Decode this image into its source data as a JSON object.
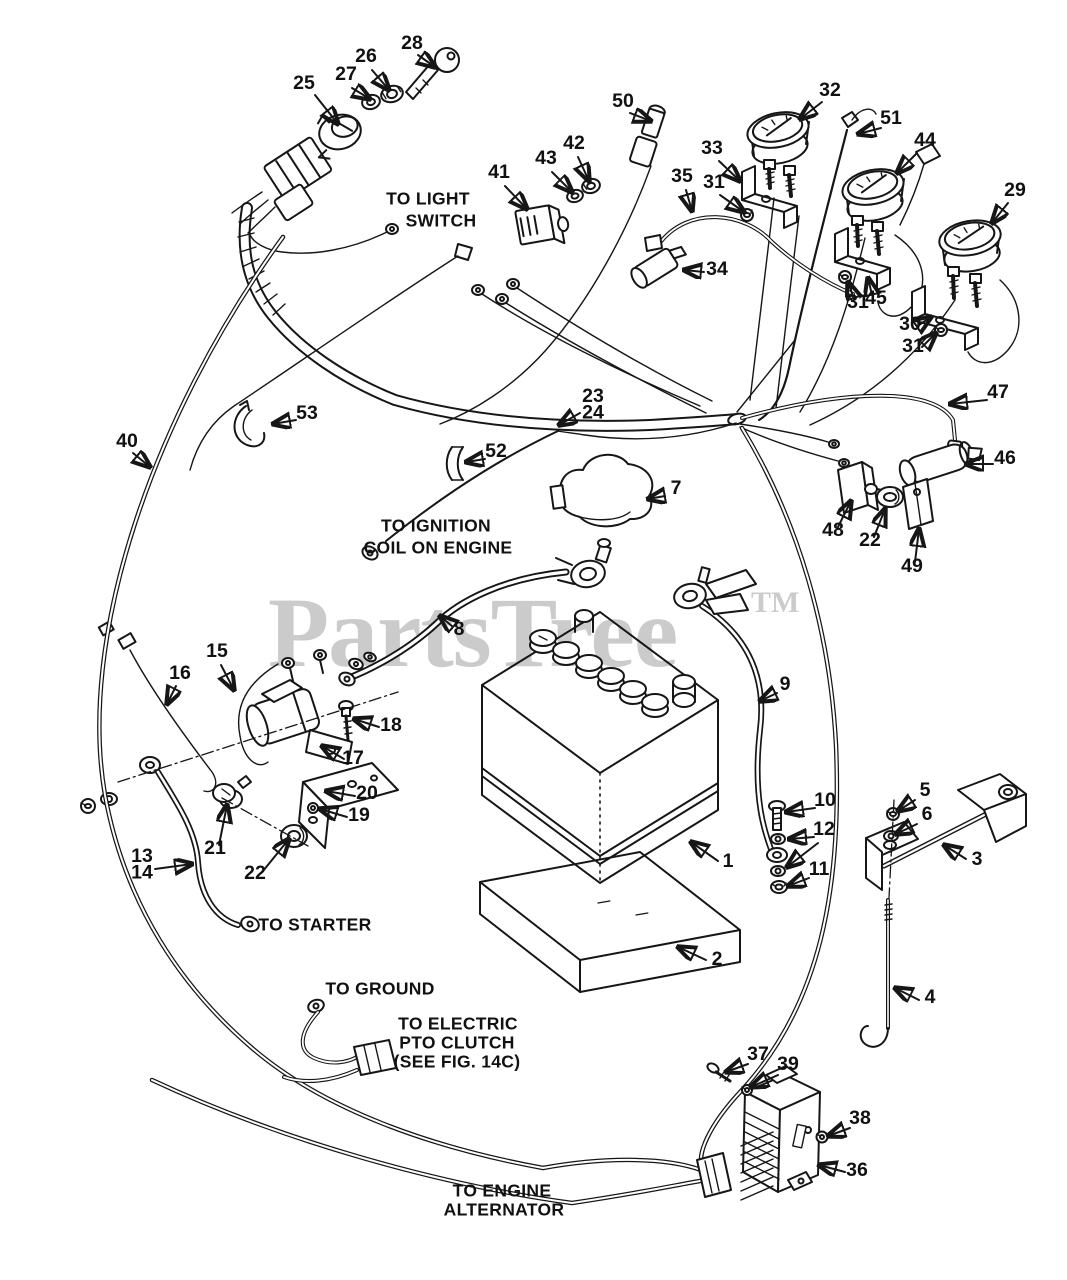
{
  "watermark": {
    "text": "PartsTree",
    "tm": "TM",
    "color": "#cbcbcb"
  },
  "colors": {
    "ink": "#161616",
    "background": "#ffffff"
  },
  "annotations": [
    {
      "id": "to-light-switch",
      "lines": [
        {
          "t": "TO LIGHT",
          "x": 428,
          "y": 200
        },
        {
          "t": "SWITCH",
          "x": 441,
          "y": 222
        }
      ]
    },
    {
      "id": "to-ignition-coil",
      "lines": [
        {
          "t": "TO IGNITION",
          "x": 436,
          "y": 527
        },
        {
          "t": "COIL ON ENGINE",
          "x": 438,
          "y": 549
        }
      ]
    },
    {
      "id": "to-starter",
      "lines": [
        {
          "t": "TO STARTER",
          "x": 315,
          "y": 926
        }
      ]
    },
    {
      "id": "to-ground",
      "lines": [
        {
          "t": "TO GROUND",
          "x": 380,
          "y": 990
        }
      ]
    },
    {
      "id": "to-electric-pto-clutch",
      "lines": [
        {
          "t": "TO ELECTRIC",
          "x": 458,
          "y": 1025
        },
        {
          "t": "PTO CLUTCH",
          "x": 457,
          "y": 1044
        },
        {
          "t": "(SEE FIG. 14C)",
          "x": 457,
          "y": 1063
        }
      ]
    },
    {
      "id": "to-engine-alternator",
      "lines": [
        {
          "t": "TO ENGINE",
          "x": 502,
          "y": 1192
        },
        {
          "t": "ALTERNATOR",
          "x": 504,
          "y": 1211
        }
      ]
    }
  ],
  "callouts": [
    {
      "id": "25",
      "lines": [
        "25"
      ],
      "x": 304,
      "y": 89,
      "arrows": [
        [
          315,
          95,
          338,
          124
        ]
      ]
    },
    {
      "id": "27",
      "lines": [
        "27"
      ],
      "x": 346,
      "y": 80,
      "arrows": [
        [
          352,
          88,
          370,
          99
        ]
      ]
    },
    {
      "id": "26",
      "lines": [
        "26"
      ],
      "x": 366,
      "y": 62,
      "arrows": [
        [
          372,
          70,
          389,
          90
        ]
      ]
    },
    {
      "id": "28",
      "lines": [
        "28"
      ],
      "x": 412,
      "y": 49,
      "arrows": [
        [
          418,
          55,
          435,
          67
        ]
      ]
    },
    {
      "id": "41",
      "lines": [
        "41"
      ],
      "x": 499,
      "y": 178,
      "arrows": [
        [
          505,
          186,
          527,
          209
        ]
      ]
    },
    {
      "id": "43",
      "lines": [
        "43"
      ],
      "x": 546,
      "y": 164,
      "arrows": [
        [
          552,
          172,
          572,
          192
        ]
      ]
    },
    {
      "id": "42",
      "lines": [
        "42"
      ],
      "x": 574,
      "y": 149,
      "arrows": [
        [
          578,
          157,
          589,
          181
        ]
      ]
    },
    {
      "id": "50",
      "lines": [
        "50"
      ],
      "x": 623,
      "y": 107,
      "arrows": [
        [
          630,
          113,
          651,
          121
        ]
      ]
    },
    {
      "id": "32",
      "lines": [
        "32"
      ],
      "x": 830,
      "y": 96,
      "arrows": [
        [
          822,
          102,
          800,
          119
        ]
      ]
    },
    {
      "id": "51",
      "lines": [
        "51"
      ],
      "x": 891,
      "y": 124,
      "arrows": [
        [
          881,
          128,
          858,
          134
        ]
      ]
    },
    {
      "id": "33",
      "lines": [
        "33"
      ],
      "x": 712,
      "y": 154,
      "arrows": [
        [
          719,
          161,
          740,
          181
        ]
      ]
    },
    {
      "id": "31a",
      "lines": [
        "31"
      ],
      "x": 714,
      "y": 188,
      "arrows": [
        [
          720,
          195,
          744,
          212
        ]
      ]
    },
    {
      "id": "35",
      "lines": [
        "35"
      ],
      "x": 682,
      "y": 182,
      "arrows": [
        [
          686,
          190,
          692,
          211
        ]
      ]
    },
    {
      "id": "34",
      "lines": [
        "34"
      ],
      "x": 717,
      "y": 275,
      "arrows": [
        [
          704,
          272,
          684,
          270
        ]
      ]
    },
    {
      "id": "44",
      "lines": [
        "44"
      ],
      "x": 925,
      "y": 146,
      "arrows": [
        [
          917,
          153,
          897,
          173
        ]
      ]
    },
    {
      "id": "29",
      "lines": [
        "29"
      ],
      "x": 1015,
      "y": 196,
      "arrows": [
        [
          1008,
          203,
          992,
          223
        ]
      ]
    },
    {
      "id": "45",
      "lines": [
        "45"
      ],
      "x": 876,
      "y": 304,
      "arrows": [
        [
          872,
          295,
          868,
          278
        ]
      ]
    },
    {
      "id": "31b",
      "lines": [
        "31"
      ],
      "x": 858,
      "y": 308,
      "arrows": [
        [
          854,
          299,
          848,
          282
        ]
      ]
    },
    {
      "id": "30",
      "lines": [
        "30"
      ],
      "x": 910,
      "y": 330,
      "arrows": [
        [
          919,
          325,
          931,
          317
        ]
      ]
    },
    {
      "id": "31c",
      "lines": [
        "31"
      ],
      "x": 913,
      "y": 352,
      "arrows": [
        [
          922,
          347,
          936,
          333
        ]
      ]
    },
    {
      "id": "23-24",
      "lines": [
        "23",
        "24"
      ],
      "x": 593,
      "y": 402,
      "arrows": [
        [
          580,
          413,
          559,
          425
        ]
      ]
    },
    {
      "id": "47",
      "lines": [
        "47"
      ],
      "x": 998,
      "y": 398,
      "arrows": [
        [
          987,
          400,
          950,
          404
        ]
      ]
    },
    {
      "id": "53",
      "lines": [
        "53"
      ],
      "x": 307,
      "y": 419,
      "arrows": [
        [
          296,
          420,
          273,
          424
        ]
      ]
    },
    {
      "id": "40",
      "lines": [
        "40"
      ],
      "x": 127,
      "y": 447,
      "arrows": [
        [
          133,
          453,
          150,
          467
        ]
      ]
    },
    {
      "id": "52",
      "lines": [
        "52"
      ],
      "x": 496,
      "y": 457,
      "arrows": [
        [
          485,
          459,
          466,
          462
        ]
      ]
    },
    {
      "id": "7",
      "lines": [
        "7"
      ],
      "x": 676,
      "y": 494,
      "arrows": [
        [
          665,
          496,
          648,
          499
        ]
      ]
    },
    {
      "id": "46",
      "lines": [
        "46"
      ],
      "x": 1005,
      "y": 464,
      "arrows": [
        [
          993,
          464,
          966,
          464
        ]
      ]
    },
    {
      "id": "48",
      "lines": [
        "48"
      ],
      "x": 833,
      "y": 536,
      "arrows": [
        [
          838,
          527,
          851,
          501
        ]
      ]
    },
    {
      "id": "22a",
      "lines": [
        "22"
      ],
      "x": 870,
      "y": 546,
      "arrows": [
        [
          874,
          537,
          885,
          509
        ]
      ]
    },
    {
      "id": "49",
      "lines": [
        "49"
      ],
      "x": 912,
      "y": 572,
      "arrows": [
        [
          915,
          562,
          919,
          529
        ]
      ]
    },
    {
      "id": "8",
      "lines": [
        "8"
      ],
      "x": 459,
      "y": 635,
      "arrows": [
        [
          453,
          627,
          440,
          616
        ]
      ]
    },
    {
      "id": "9",
      "lines": [
        "9"
      ],
      "x": 785,
      "y": 690,
      "arrows": [
        [
          777,
          693,
          760,
          701
        ]
      ]
    },
    {
      "id": "15",
      "lines": [
        "15"
      ],
      "x": 217,
      "y": 657,
      "arrows": [
        [
          221,
          665,
          234,
          690
        ]
      ]
    },
    {
      "id": "16",
      "lines": [
        "16"
      ],
      "x": 180,
      "y": 679,
      "arrows": [
        [
          176,
          686,
          167,
          704
        ]
      ]
    },
    {
      "id": "18",
      "lines": [
        "18"
      ],
      "x": 391,
      "y": 731,
      "arrows": [
        [
          379,
          727,
          354,
          719
        ]
      ]
    },
    {
      "id": "17",
      "lines": [
        "17"
      ],
      "x": 353,
      "y": 764,
      "arrows": [
        [
          344,
          759,
          322,
          746
        ]
      ]
    },
    {
      "id": "20",
      "lines": [
        "20"
      ],
      "x": 367,
      "y": 799,
      "arrows": [
        [
          355,
          796,
          326,
          791
        ]
      ]
    },
    {
      "id": "19",
      "lines": [
        "19"
      ],
      "x": 359,
      "y": 821,
      "arrows": [
        [
          347,
          817,
          320,
          809
        ]
      ]
    },
    {
      "id": "21",
      "lines": [
        "21"
      ],
      "x": 215,
      "y": 854,
      "arrows": [
        [
          219,
          845,
          227,
          805
        ]
      ]
    },
    {
      "id": "22b",
      "lines": [
        "22"
      ],
      "x": 255,
      "y": 879,
      "arrows": [
        [
          263,
          871,
          289,
          839
        ]
      ]
    },
    {
      "id": "13-14",
      "lines": [
        "13",
        "14"
      ],
      "x": 142,
      "y": 862,
      "arrows": [
        [
          155,
          869,
          192,
          864
        ]
      ]
    },
    {
      "id": "10",
      "lines": [
        "10"
      ],
      "x": 825,
      "y": 806,
      "arrows": [
        [
          815,
          808,
          786,
          812
        ]
      ]
    },
    {
      "id": "12",
      "lines": [
        "12"
      ],
      "x": 824,
      "y": 835,
      "arrows": [
        [
          814,
          837,
          789,
          839
        ],
        [
          818,
          843,
          787,
          867
        ]
      ]
    },
    {
      "id": "11",
      "lines": [
        "11"
      ],
      "x": 819,
      "y": 875,
      "arrows": [
        [
          809,
          878,
          788,
          886
        ]
      ]
    },
    {
      "id": "1",
      "lines": [
        "1"
      ],
      "x": 728,
      "y": 867,
      "arrows": [
        [
          718,
          861,
          691,
          842
        ]
      ]
    },
    {
      "id": "2",
      "lines": [
        "2"
      ],
      "x": 717,
      "y": 965,
      "arrows": [
        [
          706,
          960,
          678,
          947
        ]
      ]
    },
    {
      "id": "5",
      "lines": [
        "5"
      ],
      "x": 925,
      "y": 796,
      "arrows": [
        [
          915,
          800,
          898,
          811
        ]
      ]
    },
    {
      "id": "6",
      "lines": [
        "6"
      ],
      "x": 927,
      "y": 820,
      "arrows": [
        [
          917,
          824,
          896,
          834
        ]
      ]
    },
    {
      "id": "3",
      "lines": [
        "3"
      ],
      "x": 977,
      "y": 865,
      "arrows": [
        [
          966,
          859,
          944,
          845
        ]
      ]
    },
    {
      "id": "4",
      "lines": [
        "4"
      ],
      "x": 930,
      "y": 1003,
      "arrows": [
        [
          919,
          1000,
          895,
          988
        ]
      ]
    },
    {
      "id": "37",
      "lines": [
        "37"
      ],
      "x": 758,
      "y": 1060,
      "arrows": [
        [
          748,
          1064,
          726,
          1072
        ]
      ]
    },
    {
      "id": "39",
      "lines": [
        "39"
      ],
      "x": 788,
      "y": 1070,
      "arrows": [
        [
          778,
          1075,
          751,
          1087
        ]
      ]
    },
    {
      "id": "38",
      "lines": [
        "38"
      ],
      "x": 860,
      "y": 1124,
      "arrows": [
        [
          850,
          1128,
          828,
          1136
        ]
      ]
    },
    {
      "id": "36",
      "lines": [
        "36"
      ],
      "x": 857,
      "y": 1176,
      "arrows": [
        [
          845,
          1172,
          819,
          1165
        ]
      ]
    }
  ]
}
